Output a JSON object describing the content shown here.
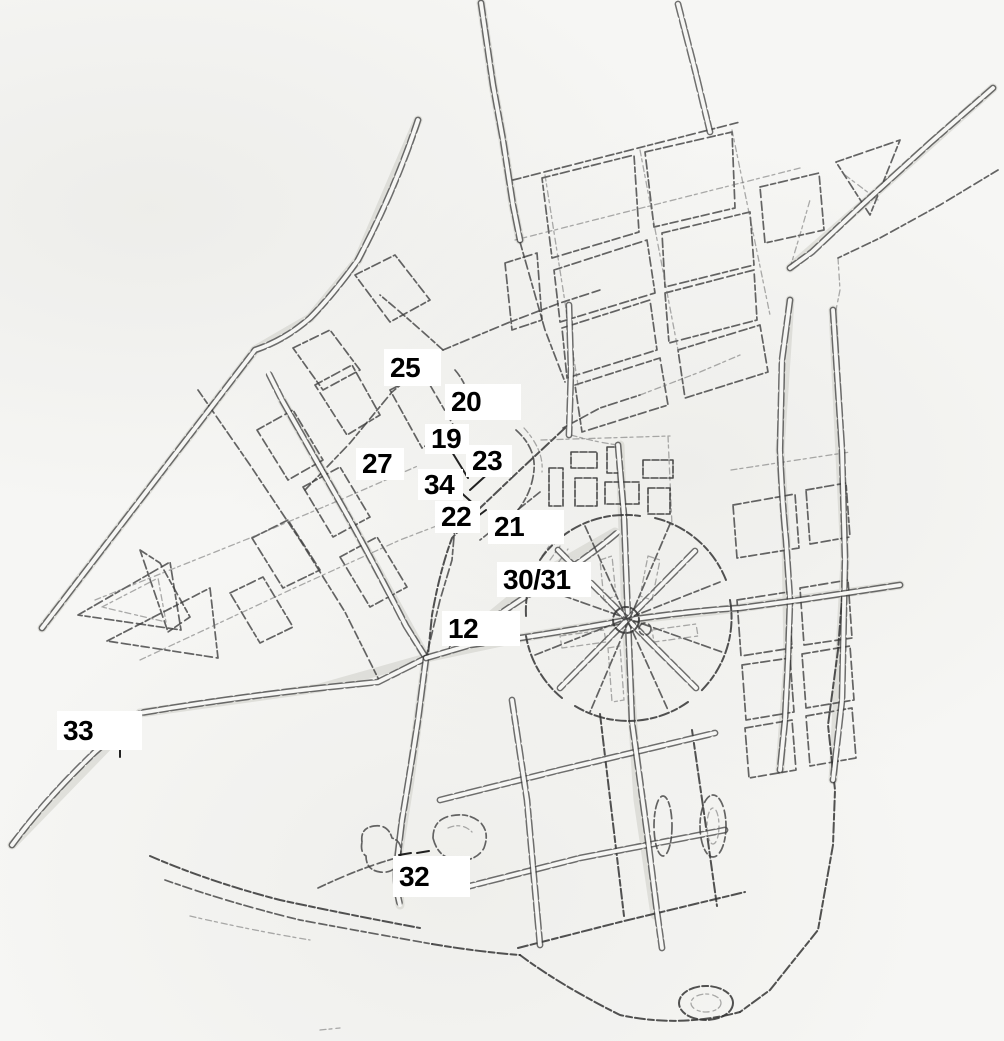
{
  "map": {
    "kind": "hand-drawn-street-map-sketch",
    "paper_color": "#f6f6f4",
    "ink_color": "#3f3f3f",
    "label_background": "#ffffff",
    "label_text_color": "#000000"
  },
  "markers": [
    {
      "id": "25",
      "label": "25",
      "x": 384,
      "y": 349,
      "w": 57,
      "h": 37
    },
    {
      "id": "20",
      "label": "20",
      "x": 445,
      "y": 384,
      "w": 76,
      "h": 36
    },
    {
      "id": "19",
      "label": "19",
      "x": 425,
      "y": 424,
      "w": 44,
      "h": 30
    },
    {
      "id": "27",
      "label": "27",
      "x": 356,
      "y": 448,
      "w": 48,
      "h": 32
    },
    {
      "id": "23",
      "label": "23",
      "x": 466,
      "y": 445,
      "w": 46,
      "h": 32
    },
    {
      "id": "34",
      "label": "34",
      "x": 418,
      "y": 469,
      "w": 45,
      "h": 31
    },
    {
      "id": "22",
      "label": "22",
      "x": 435,
      "y": 501,
      "w": 45,
      "h": 32
    },
    {
      "id": "21",
      "label": "21",
      "x": 488,
      "y": 510,
      "w": 76,
      "h": 34
    },
    {
      "id": "30/31",
      "label": "30/31",
      "x": 497,
      "y": 562,
      "w": 94,
      "h": 35
    },
    {
      "id": "12",
      "label": "12",
      "x": 442,
      "y": 611,
      "w": 78,
      "h": 35
    },
    {
      "id": "33",
      "label": "33",
      "x": 57,
      "y": 711,
      "w": 85,
      "h": 39
    },
    {
      "id": "32",
      "label": "32",
      "x": 393,
      "y": 856,
      "w": 77,
      "h": 41
    }
  ]
}
